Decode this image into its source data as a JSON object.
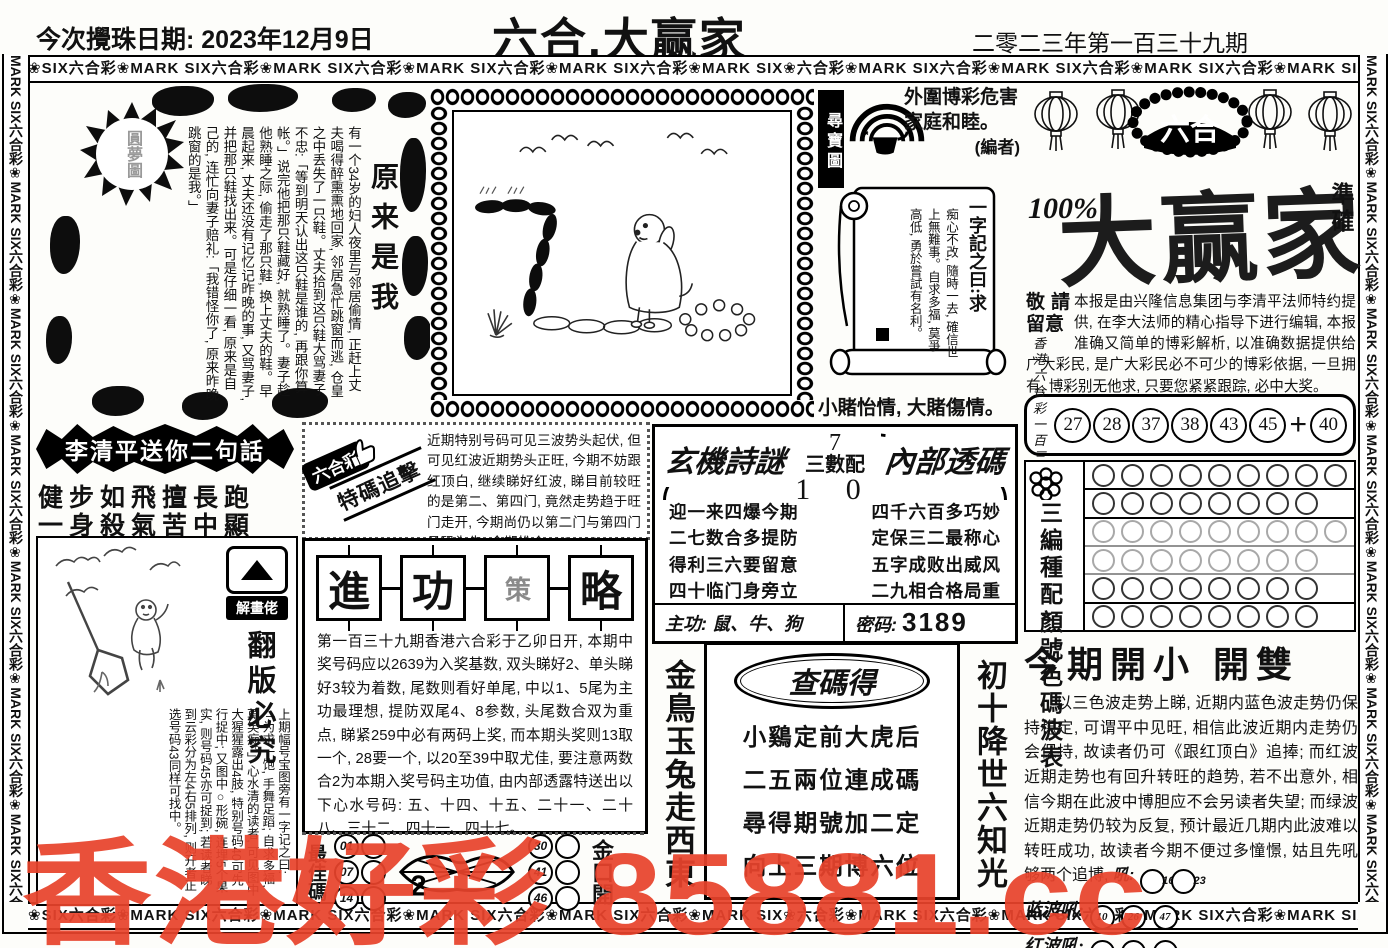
{
  "page": {
    "draw_label": "今次攪珠日期:",
    "draw_date": "2023年12月9日",
    "title": "六合.大赢家",
    "issue": "二零二三年第一百三十九期"
  },
  "borders": {
    "horizontal": "❀SIX六合彩❀MARK SIX六合彩❀MARK SIX六合彩❀MARK SIX六合彩❀MARK SIX六合彩❀MARK SIX❀六合彩❀MARK SIX六合彩❀MARK SIX六合彩❀MARK SIX六合彩❀MARK SIX六合彩❀MARK SIX六合彩❀MARK SIX❀六合彩❀MARK SIX六合彩❀MARK SIX",
    "vertical": "MARK SIX六合彩❀MARK SIX六合彩❀MARK SIX六合彩❀MARK SIX六合彩❀MARK SIX六合彩❀MARK SIX六合彩❀MARK SIX六合彩❀MARK SIX六合彩❀"
  },
  "story": {
    "title": "原来是我",
    "text": "有一个34岁的妇人夜里与邻居偷情, 正赶上丈夫喝得醉熏熏地回家, 邻居急忙跳窗而逃, 仓皇之中丢失了一只鞋。丈夫拾到这只鞋大骂妻子不忠:「等到明天认出这只鞋是谁的, 再跟你算帐。」说完他把那只鞋藏好, 就熟睡了。妻子趁他熟睡之际, 偷走了那只鞋, 换上丈夫的鞋。早晨起来, 丈夫还没有记忆记昨晚的事, 又骂妻子, 并把那只鞋找出来。可是仔细一看, 原来是自己的, 连忙向妻子赔礼:「我错怪你了, 原来昨晚跳窗的是我。」",
    "stamp": "圓夢圖"
  },
  "couplet": {
    "banner": "李清平送你二句話",
    "line1": "健步如飛擅長跑",
    "line2": "一身殺氣苦中顯"
  },
  "decode": {
    "badge": "解畫佬",
    "warning": "翻版必究",
    "text": "上期幅号宝图旁有一字记之曰:「为求一饱, 手舞足蹈; 自求多福, 莫笑痴。」心水清的读者, 可见图中大猩猩露出4肢, 特别号码40可先行捉中; 又图中○形碗, 连埋5个果实, 则号码45亦可捉到; 若读者睇到云彩分为左4右5排列, 则开者正选号码43同样可找中。"
  },
  "special": {
    "tag1": "六合彩",
    "tag2": "特碼追擊",
    "text": "近期特别号码可见三波势头起伏, 但可见红波近期势头正旺, 今期不妨跟红顶白, 继续睇好红波, 睇目前较旺的是第二、第四门, 竟然走势趋于旺门走开, 今期尚仍以第二门与第四门号码为先, 今期推介: 14、20、41、42、47。"
  },
  "strategy": {
    "seals": [
      "進",
      "功",
      "策",
      "略"
    ],
    "text": "第一百三十九期香港六合彩于乙卯日开, 本期中奖号码应以2639为入奖基数, 双头睇好2、单头睇好3较为着数, 尾数则看好单尾, 中以1、5尾为主功最理想, 提防双尾4、8参数, 头尾数合双为重点, 睇紧259中必有两码上奖, 而本期头奖则13取一个, 28要一个, 以20至39中取尤佳, 要注意两数合2为本期入奖号码主功值, 由内部透露特送出以下心水号码: 五、十四、十五、二十一、二十八、三十二、四十一、四十七。"
  },
  "best": {
    "left_label": "最佳碼",
    "left": [
      "01",
      "07",
      "14"
    ],
    "lip_digit": "2",
    "right": [
      "30",
      "41",
      "46"
    ],
    "right_label": "金口開"
  },
  "scrollsec": {
    "badge": "尋寶圖",
    "notice": "外圍博彩危害家庭和睦。",
    "editor": "(編者)",
    "head": "一字記之曰:求",
    "body": "痴心不改, 隨時一去, 確信世上無難事。自求多福, 莫爭高低, 勇於嘗試有名利。",
    "footer": "小賭怡情, 大賭傷情。"
  },
  "poembox": {
    "header_left": "玄機詩謎",
    "digit_top": "7",
    "center_label": "三數配",
    "digits_bottom": "1 0",
    "header_right": "內部透碼",
    "left_poem": [
      "迎一来四爆今期",
      "二七数合多提防",
      "得利三六要留意",
      "四十临门身旁立"
    ],
    "right_poem": [
      "四千六百多巧妙",
      "定保三二最称心",
      "五字成败出威风",
      "二九相合格局重"
    ],
    "zhugong_label": "主功:",
    "zhugong": "鼠、牛、狗",
    "password_label": "密码:",
    "password": "3189"
  },
  "codeverse": {
    "left_vertical": "金鳥玉兔走西東",
    "oval_title": "查碼得",
    "lines": [
      "小鷄定前大虎后",
      "二五兩位連成碼",
      "尋得期號加二定",
      "向上三期博六位"
    ],
    "right_vertical": "初十降世六知光"
  },
  "brand": {
    "logo": "六合",
    "percent": "100%",
    "name": "大赢家",
    "accuracy": "準確",
    "notice_title": "敬請留意",
    "notice": "本报是由兴隆信息集团与李清平法师特约提供, 在李大法师的精心指导下进行编辑, 本报准确又简单的博彩解析, 以准确数据提供给广大彩民, 是广大彩民必不可少的博彩依据, 一旦拥有, 博彩别无他求, 只要您紧紧跟踪, 必中大奖。"
  },
  "results": {
    "region": "香港六合彩",
    "issue": "一百三十七期",
    "numbers": [
      "27",
      "28",
      "37",
      "38",
      "43",
      "45"
    ],
    "plus": "+",
    "special": "40"
  },
  "wave": {
    "labels": [
      "三編",
      "種配",
      "顏號",
      "色碼",
      "波表"
    ],
    "row_counts": [
      9,
      8,
      9,
      8,
      8,
      8
    ]
  },
  "forecast": {
    "headline": "今期開小  開雙",
    "body": "以三色波走势上睇, 近期内蓝色波走势仍保持稳定, 可谓平中见旺, 相信此波近期内走势仍会保持, 故读者仍可《跟红顶白》追捧; 而红波近期走势也有回升转旺的趋势, 若不出意外, 相信今期在此波中博胆应不会另读者失望; 而绿波近期走势仍较为反复, 预计最近几期内此波难以转旺成功, 故读者今期不便过多憧憬, 姑且先吼够两个追博, ",
    "hou_label": "吼:",
    "hou": [
      "16",
      "23"
    ],
    "blue_label": "蓝波吼:",
    "blue": [
      "10",
      "26",
      "47"
    ],
    "red_label": "红波吼:",
    "red": [
      "02",
      "13",
      "24"
    ]
  },
  "watermark": {
    "text": "香港好彩 85881.cc",
    "color": "#e8432c"
  }
}
